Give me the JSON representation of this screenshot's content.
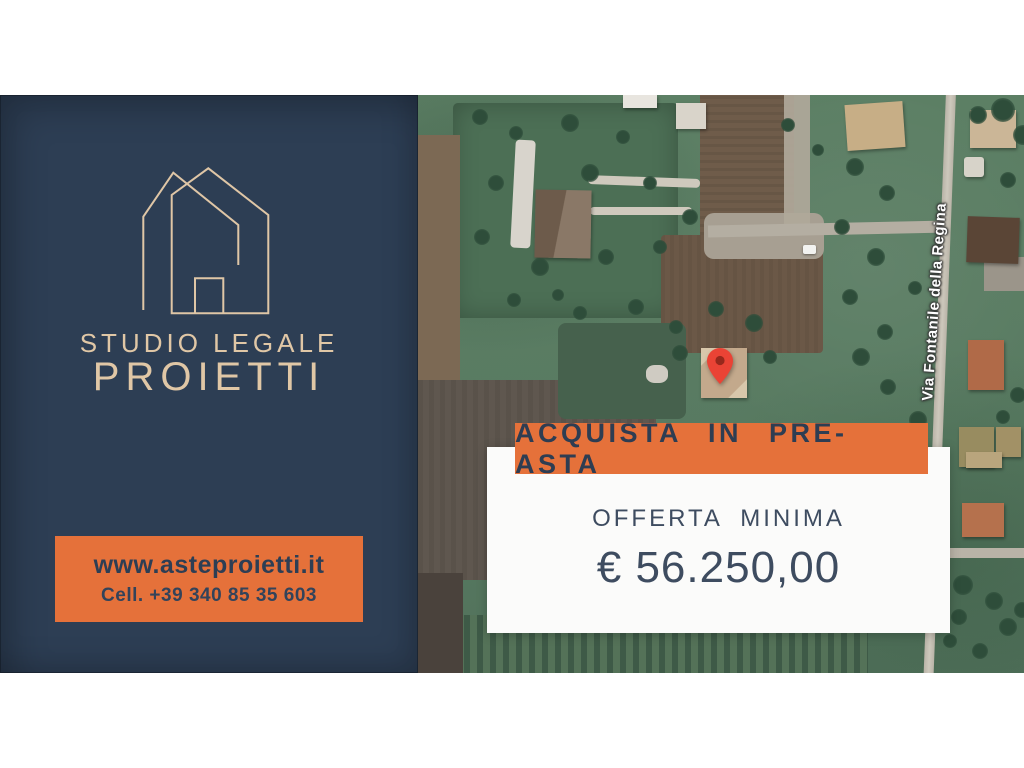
{
  "left_panel": {
    "logo": "house-outline-logo",
    "studio_line1": "STUDIO LEGALE",
    "studio_line2": "PROIETTI",
    "contact": {
      "website": "www.asteproietti.it",
      "phone": "Cell. +39 340 85 35 603"
    }
  },
  "offer": {
    "banner_label": "ACQUISTA IN PRE-ASTA",
    "offer_label": "OFFERTA MINIMA",
    "offer_amount": "€ 56.250,00"
  },
  "map": {
    "type": "satellite",
    "street_label": "Via Fontanile della Regina",
    "marker": "red-map-pin"
  },
  "colors": {
    "navy": "#2D3E54",
    "orange": "#E5713A",
    "cream": "#E0C7A6",
    "card_bg": "#FBFBFA",
    "pin_red": "#EA4335",
    "text_dark": "#3E4C60"
  }
}
